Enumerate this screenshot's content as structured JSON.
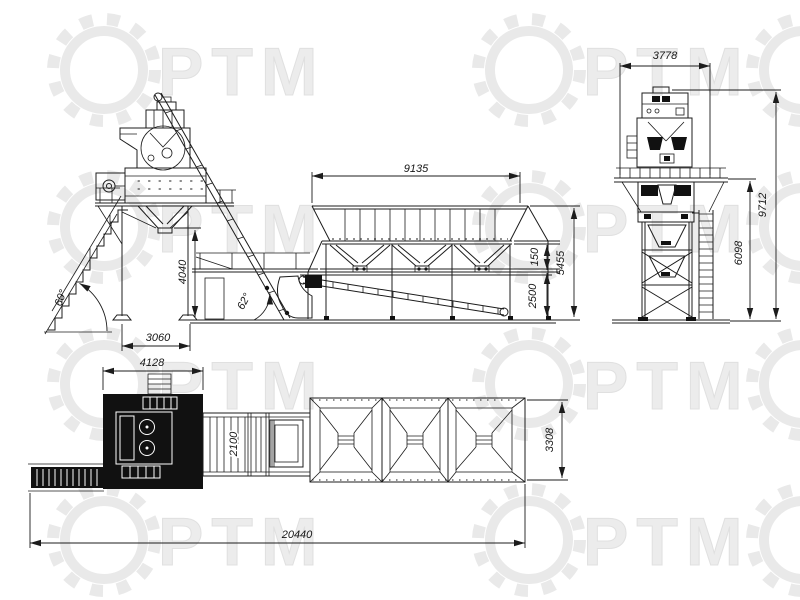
{
  "title": "Concrete batching plant - general arrangement drawing",
  "watermark": {
    "text": "PTM",
    "color": "#e9e9e9"
  },
  "line_color": "#1c1c1c",
  "dimensions": {
    "side_view": {
      "bins_length": "9135",
      "clearance_height": "4040",
      "support_span": "3060",
      "stairs_angle": "60°",
      "skip_rail_angle": "62°",
      "belt_lip": "150",
      "discharge_height": "2500",
      "bins_total_height": "5455"
    },
    "front_view": {
      "width": "3778",
      "total_height": "9712",
      "tower_height": "6098"
    },
    "plan_view": {
      "mixer_block": "4128",
      "conveyor_width": "2100",
      "bins_width": "3308",
      "total_length": "20440"
    }
  }
}
